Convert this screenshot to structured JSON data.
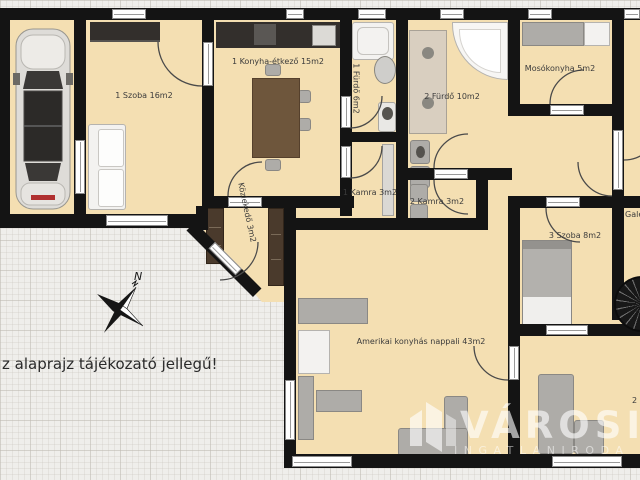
{
  "floor_plan": {
    "disclaimer": "z alaprajz tájékozató jellegű!",
    "compass": "N",
    "rooms": {
      "szoba1": "1 Szoba 16m2",
      "konyha": "1 Konyha-étkező 15m2",
      "furdo1": "1 Fürdő 6m2",
      "furdo2": "2 Fürdő 10m2",
      "mosokonyha": "Mosókonyha 5m2",
      "kamra1": "1 Kamra 3m2",
      "kamra2": "2 Kamra 3m2",
      "kozlekedo": "Közlekedő 3m2",
      "szoba3": "3 Szoba 8m2",
      "nappali": "Amerikai konyhás nappali 43m2",
      "galeria": "Galéria",
      "szoba2_partial": "2 Szoba"
    },
    "watermark": {
      "brand": "VÁROSI",
      "subtitle": "INGATLANIRODA"
    },
    "colors": {
      "floor": "#f4dfb2",
      "wall": "#141414",
      "paper": "#efeeeb",
      "wood": "#6e563c"
    }
  }
}
